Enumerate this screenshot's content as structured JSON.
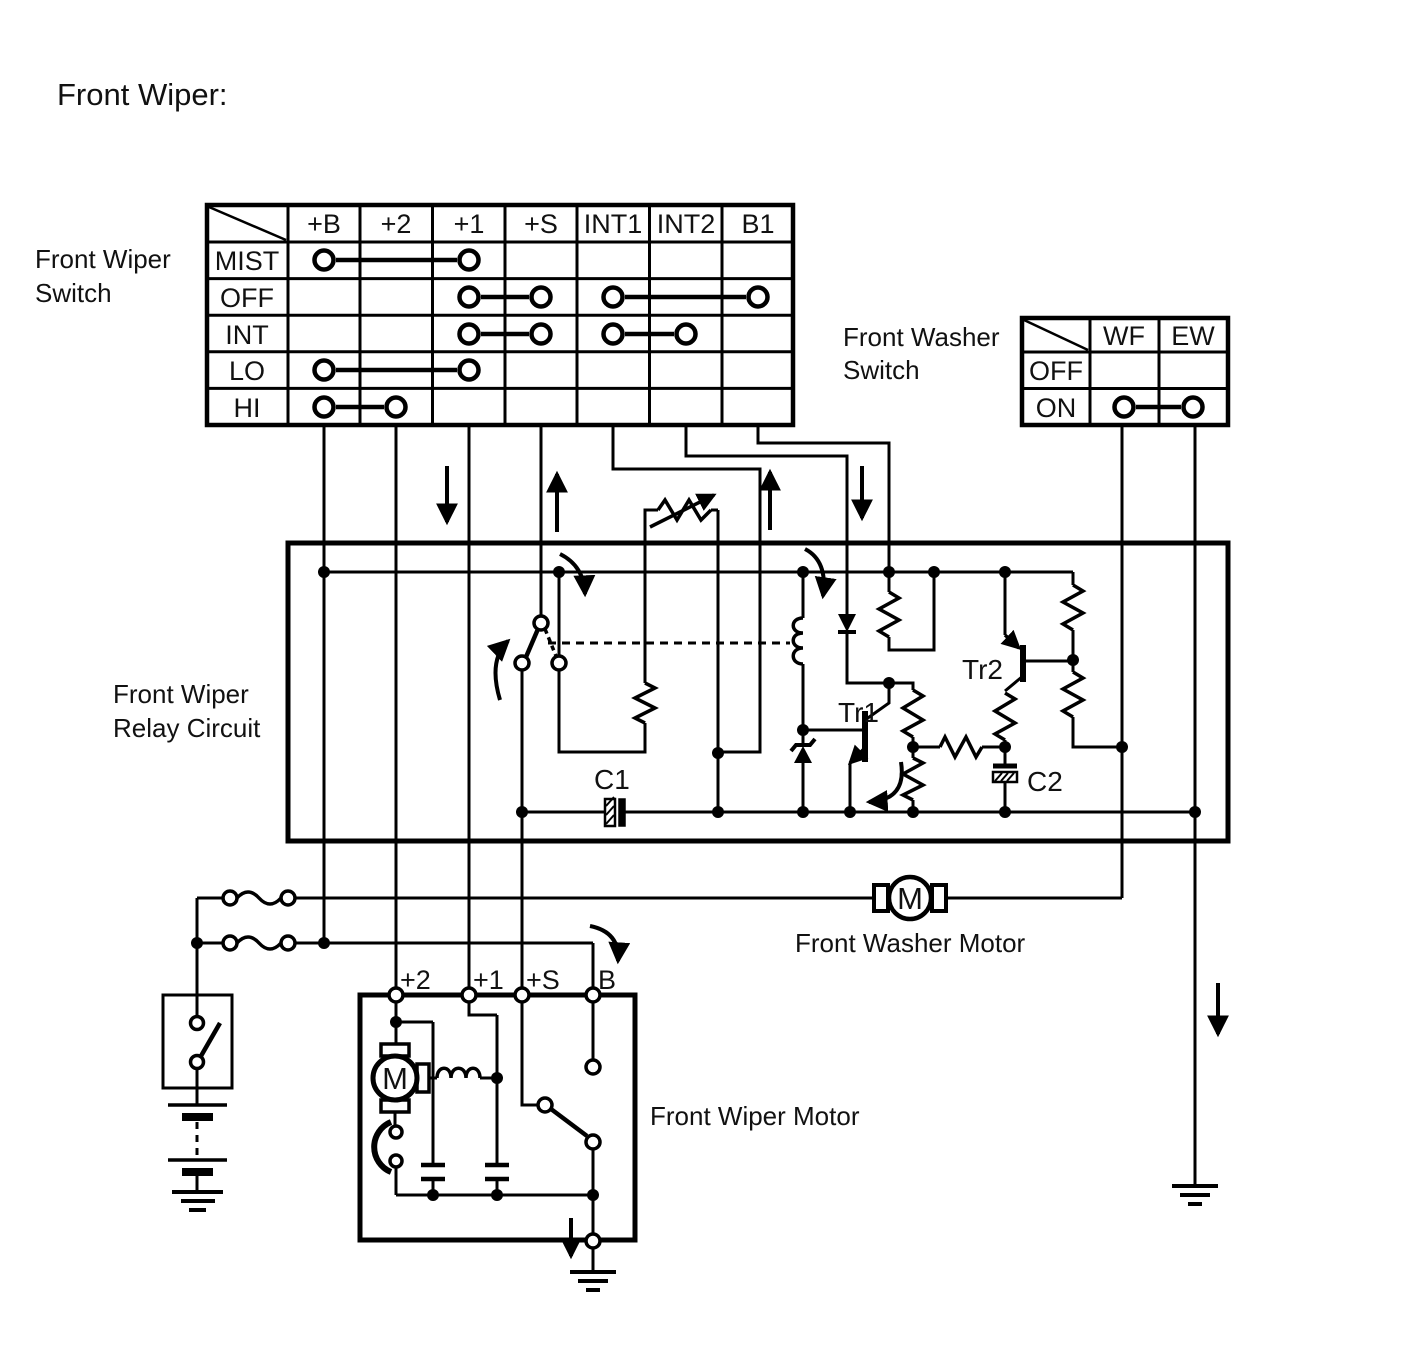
{
  "title": "Front Wiper:",
  "wiper_switch": {
    "label_line1": "Front Wiper",
    "label_line2": "Switch",
    "columns": [
      "+B",
      "+2",
      "+1",
      "+S",
      "INT1",
      "INT2",
      "B1"
    ],
    "rows": [
      "MIST",
      "OFF",
      "INT",
      "LO",
      "HI"
    ],
    "connections": [
      {
        "row": "MIST",
        "pairs": [
          [
            "+B",
            "+1"
          ]
        ]
      },
      {
        "row": "OFF",
        "pairs": [
          [
            "+1",
            "+S"
          ],
          [
            "INT1",
            "B1"
          ]
        ]
      },
      {
        "row": "INT",
        "pairs": [
          [
            "+1",
            "+S"
          ],
          [
            "INT1",
            "INT2"
          ]
        ]
      },
      {
        "row": "LO",
        "pairs": [
          [
            "+B",
            "+1"
          ]
        ]
      },
      {
        "row": "HI",
        "pairs": [
          [
            "+B",
            "+2"
          ]
        ]
      }
    ]
  },
  "washer_switch": {
    "label_line1": "Front Washer",
    "label_line2": "Switch",
    "columns": [
      "WF",
      "EW"
    ],
    "rows": [
      "OFF",
      "ON"
    ],
    "connections": [
      {
        "row": "ON",
        "pairs": [
          [
            "WF",
            "EW"
          ]
        ]
      }
    ]
  },
  "relay": {
    "label_line1": "Front Wiper",
    "label_line2": "Relay Circuit",
    "component_labels": {
      "c1": "C1",
      "c2": "C2",
      "tr1": "Tr1",
      "tr2": "Tr2"
    }
  },
  "washer_motor": {
    "label": "Front Washer Motor",
    "symbol": "M"
  },
  "wiper_motor": {
    "label": "Front Wiper Motor",
    "symbol": "M",
    "terminals": [
      "+2",
      "+1",
      "+S",
      "B"
    ]
  },
  "colors": {
    "line": "#000000",
    "text": "#111111",
    "background": "#ffffff"
  }
}
